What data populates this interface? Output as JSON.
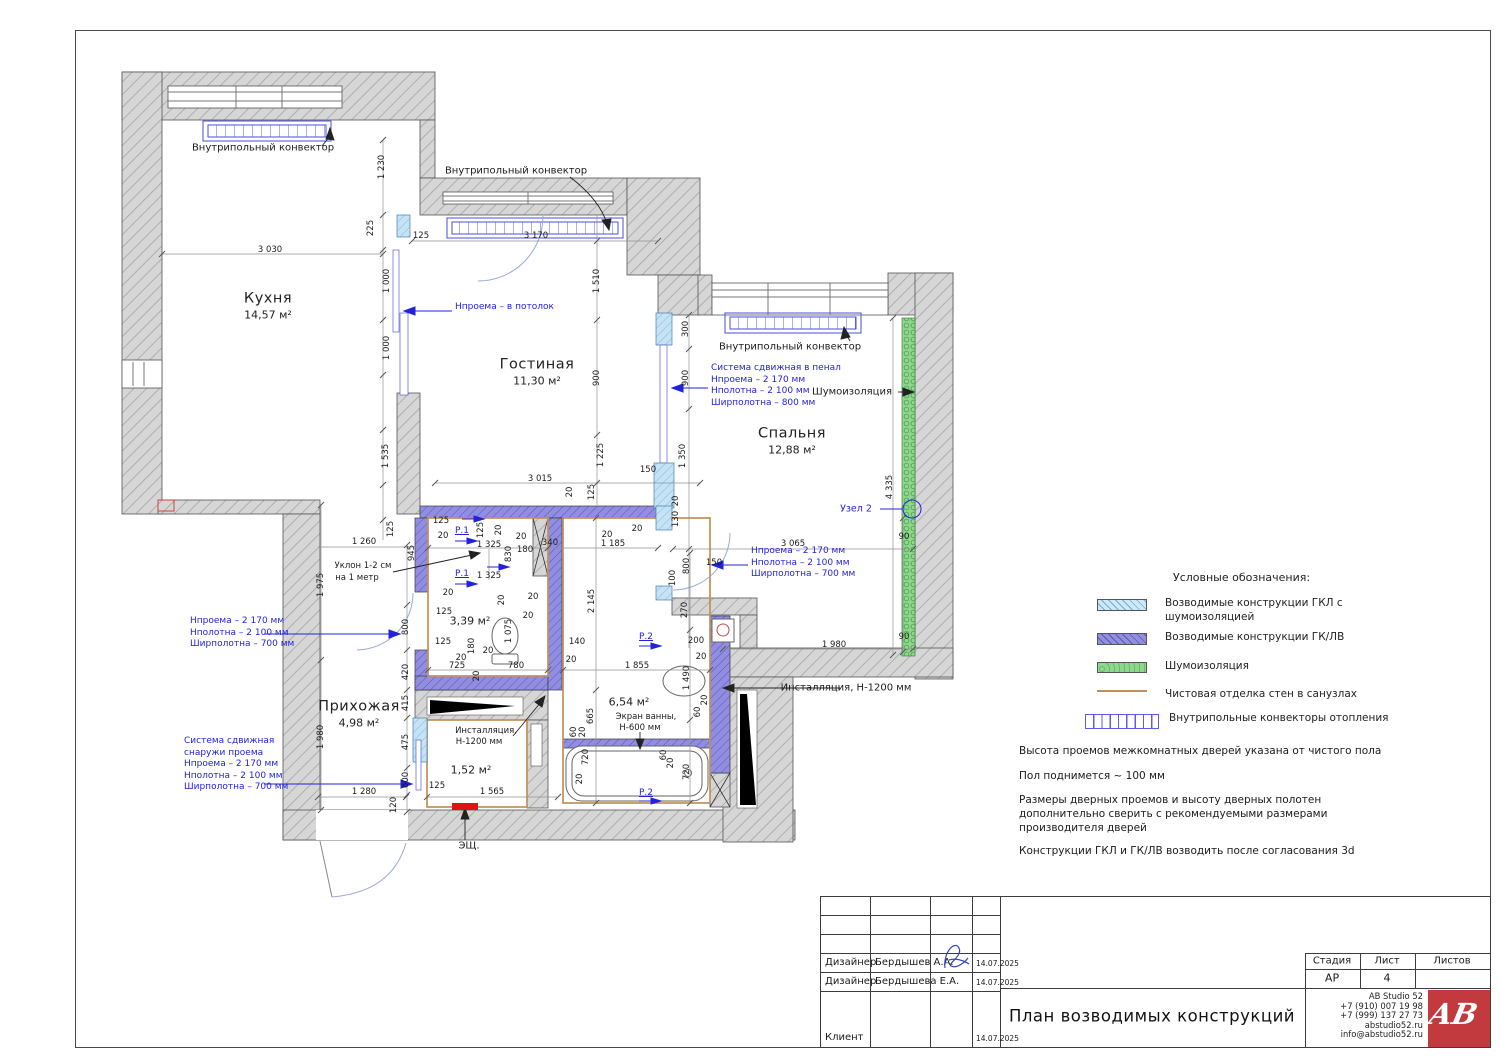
{
  "plan": {
    "rooms": [
      {
        "name": "Кухня",
        "area": "14,57 м²",
        "x": 268,
        "y": 306
      },
      {
        "name": "Гостиная",
        "area": "11,30 м²",
        "x": 537,
        "y": 372
      },
      {
        "name": "Спальня",
        "area": "12,88 м²",
        "x": 792,
        "y": 441
      },
      {
        "name": "Прихожая",
        "area": "4,98 м²",
        "x": 359,
        "y": 714
      },
      {
        "name": "",
        "area": "3,39 м²",
        "x": 470,
        "y": 620
      },
      {
        "name": "",
        "area": "6,54 м²",
        "x": 629,
        "y": 701
      },
      {
        "name": "",
        "area": "1,52 м²",
        "x": 471,
        "y": 769
      }
    ],
    "labels": [
      {
        "t": "Внутрипольный конвектор",
        "x": 263,
        "y": 148,
        "c": "big"
      },
      {
        "t": "Внутрипольный конвектор",
        "x": 516,
        "y": 171,
        "c": "big"
      },
      {
        "t": "Внутрипольный конвектор",
        "x": 790,
        "y": 347,
        "c": "big"
      },
      {
        "t": "Шумоизоляция",
        "x": 852,
        "y": 392,
        "c": "big"
      },
      {
        "t": "Узел 2",
        "x": 856,
        "y": 509,
        "c": "bluep"
      },
      {
        "t": "Уклон 1-2 см",
        "x": 363,
        "y": 566
      },
      {
        "t": "на 1 метр",
        "x": 357,
        "y": 578
      },
      {
        "t": "Инсталляция,",
        "x": 486,
        "y": 731
      },
      {
        "t": "Н-1200 мм",
        "x": 479,
        "y": 742
      },
      {
        "t": "Инсталляция, Н-1200 мм",
        "x": 846,
        "y": 688,
        "c": "big"
      },
      {
        "t": "Экран ванны,",
        "x": 646,
        "y": 717
      },
      {
        "t": "Н-600 мм",
        "x": 640,
        "y": 728
      },
      {
        "t": "ЭЩ.",
        "x": 469,
        "y": 846,
        "c": "big"
      },
      {
        "t": "3 030",
        "x": 270,
        "y": 250
      },
      {
        "t": "1 230",
        "x": 382,
        "y": 167,
        "r": 1
      },
      {
        "t": "225",
        "x": 371,
        "y": 228,
        "r": 1
      },
      {
        "t": "125",
        "x": 421,
        "y": 236
      },
      {
        "t": "3 170",
        "x": 536,
        "y": 236
      },
      {
        "t": "1 510",
        "x": 597,
        "y": 281,
        "r": 1
      },
      {
        "t": "900",
        "x": 597,
        "y": 378,
        "r": 1
      },
      {
        "t": "1 000",
        "x": 387,
        "y": 281,
        "r": 1
      },
      {
        "t": "1 000",
        "x": 387,
        "y": 348,
        "r": 1
      },
      {
        "t": "1 535",
        "x": 386,
        "y": 456,
        "r": 1
      },
      {
        "t": "125",
        "x": 391,
        "y": 529,
        "r": 1
      },
      {
        "t": "300",
        "x": 686,
        "y": 329,
        "r": 1
      },
      {
        "t": "900",
        "x": 686,
        "y": 378,
        "r": 1
      },
      {
        "t": "1 350",
        "x": 683,
        "y": 456,
        "r": 1
      },
      {
        "t": "1 225",
        "x": 601,
        "y": 455,
        "r": 1
      },
      {
        "t": "150",
        "x": 648,
        "y": 470
      },
      {
        "t": "3 015",
        "x": 540,
        "y": 479
      },
      {
        "t": "20",
        "x": 570,
        "y": 492,
        "r": 1
      },
      {
        "t": "125",
        "x": 592,
        "y": 492,
        "r": 1
      },
      {
        "t": "130",
        "x": 676,
        "y": 519,
        "r": 1
      },
      {
        "t": "20",
        "x": 676,
        "y": 501,
        "r": 1
      },
      {
        "t": "150",
        "x": 714,
        "y": 563
      },
      {
        "t": "100",
        "x": 673,
        "y": 578,
        "r": 1
      },
      {
        "t": "800",
        "x": 687,
        "y": 566,
        "r": 1
      },
      {
        "t": "270",
        "x": 685,
        "y": 610,
        "r": 1
      },
      {
        "t": "3 065",
        "x": 793,
        "y": 544
      },
      {
        "t": "90",
        "x": 904,
        "y": 537
      },
      {
        "t": "90",
        "x": 904,
        "y": 637
      },
      {
        "t": "1 980",
        "x": 834,
        "y": 645
      },
      {
        "t": "4 335",
        "x": 890,
        "y": 487,
        "r": 1
      },
      {
        "t": "1 260",
        "x": 364,
        "y": 542
      },
      {
        "t": "945",
        "x": 412,
        "y": 553,
        "r": 1
      },
      {
        "t": "1 975",
        "x": 321,
        "y": 585,
        "r": 1
      },
      {
        "t": "1 980",
        "x": 321,
        "y": 737,
        "r": 1
      },
      {
        "t": "800",
        "x": 406,
        "y": 627,
        "r": 1
      },
      {
        "t": "420",
        "x": 406,
        "y": 672,
        "r": 1
      },
      {
        "t": "415",
        "x": 406,
        "y": 703,
        "r": 1
      },
      {
        "t": "475",
        "x": 406,
        "y": 742,
        "r": 1
      },
      {
        "t": "600",
        "x": 406,
        "y": 780,
        "r": 1
      },
      {
        "t": "120",
        "x": 394,
        "y": 805,
        "r": 1
      },
      {
        "t": "1 280",
        "x": 364,
        "y": 792
      },
      {
        "t": "125",
        "x": 437,
        "y": 786
      },
      {
        "t": "1 565",
        "x": 492,
        "y": 792
      },
      {
        "t": "125",
        "x": 441,
        "y": 521
      },
      {
        "t": "20",
        "x": 443,
        "y": 536
      },
      {
        "t": "Р.1",
        "x": 462,
        "y": 531,
        "c": "blue"
      },
      {
        "t": "125",
        "x": 481,
        "y": 530,
        "r": 1
      },
      {
        "t": "20",
        "x": 499,
        "y": 530,
        "r": 1
      },
      {
        "t": "1 325",
        "x": 489,
        "y": 545
      },
      {
        "t": "20",
        "x": 521,
        "y": 537
      },
      {
        "t": "830",
        "x": 509,
        "y": 554,
        "r": 1
      },
      {
        "t": "180",
        "x": 525,
        "y": 550
      },
      {
        "t": "340",
        "x": 550,
        "y": 543
      },
      {
        "t": "Р.1",
        "x": 462,
        "y": 574,
        "c": "blue"
      },
      {
        "t": "1 325",
        "x": 489,
        "y": 576
      },
      {
        "t": "20",
        "x": 448,
        "y": 593
      },
      {
        "t": "125",
        "x": 444,
        "y": 612
      },
      {
        "t": "20",
        "x": 502,
        "y": 600,
        "r": 1
      },
      {
        "t": "20",
        "x": 533,
        "y": 597
      },
      {
        "t": "1 075",
        "x": 509,
        "y": 631,
        "r": 1
      },
      {
        "t": "20",
        "x": 528,
        "y": 616
      },
      {
        "t": "125",
        "x": 443,
        "y": 642
      },
      {
        "t": "180",
        "x": 472,
        "y": 646,
        "r": 1
      },
      {
        "t": "20",
        "x": 488,
        "y": 651
      },
      {
        "t": "20",
        "x": 461,
        "y": 658
      },
      {
        "t": "725",
        "x": 457,
        "y": 666
      },
      {
        "t": "780",
        "x": 516,
        "y": 666
      },
      {
        "t": "20",
        "x": 477,
        "y": 676,
        "r": 1
      },
      {
        "t": "20",
        "x": 607,
        "y": 535
      },
      {
        "t": "1 185",
        "x": 613,
        "y": 544
      },
      {
        "t": "140",
        "x": 577,
        "y": 642
      },
      {
        "t": "20",
        "x": 571,
        "y": 660
      },
      {
        "t": "1 855",
        "x": 637,
        "y": 666
      },
      {
        "t": "2 145",
        "x": 592,
        "y": 601,
        "r": 1
      },
      {
        "t": "665",
        "x": 591,
        "y": 716,
        "r": 1
      },
      {
        "t": "60",
        "x": 574,
        "y": 732,
        "r": 1
      },
      {
        "t": "20",
        "x": 583,
        "y": 732,
        "r": 1
      },
      {
        "t": "720",
        "x": 586,
        "y": 757,
        "r": 1
      },
      {
        "t": "20",
        "x": 580,
        "y": 779,
        "r": 1
      },
      {
        "t": "Р.2",
        "x": 646,
        "y": 637,
        "c": "blue"
      },
      {
        "t": "Р.2",
        "x": 646,
        "y": 793,
        "c": "blue"
      },
      {
        "t": "200",
        "x": 696,
        "y": 641
      },
      {
        "t": "20",
        "x": 701,
        "y": 657
      },
      {
        "t": "1 490",
        "x": 687,
        "y": 678,
        "r": 1
      },
      {
        "t": "20",
        "x": 705,
        "y": 700,
        "r": 1
      },
      {
        "t": "60",
        "x": 698,
        "y": 712,
        "r": 1
      },
      {
        "t": "720",
        "x": 687,
        "y": 772,
        "r": 1
      },
      {
        "t": "20",
        "x": 671,
        "y": 763,
        "r": 1
      },
      {
        "t": "60",
        "x": 664,
        "y": 755,
        "r": 1
      },
      {
        "t": "20",
        "x": 637,
        "y": 529
      }
    ],
    "annotations": [
      {
        "x": 455,
        "y": 302,
        "lines": [
          "Нпроема – в потолок"
        ]
      },
      {
        "x": 711,
        "y": 363,
        "lines": [
          "Система сдвижная в пенал",
          "Нпроема – 2 170 мм",
          "Нполотна – 2 100 мм",
          "Ширполотна – 800 мм"
        ]
      },
      {
        "x": 751,
        "y": 546,
        "lines": [
          "Нпроема – 2 170 мм",
          "Нполотна – 2 100 мм",
          "Ширполотна – 700 мм"
        ]
      },
      {
        "x": 190,
        "y": 616,
        "lines": [
          "Нпроема – 2 170 мм",
          "Нполотна – 2 100 мм",
          "Ширполотна – 700 мм"
        ]
      },
      {
        "x": 184,
        "y": 736,
        "lines": [
          "Система сдвижная",
          "снаружи проема",
          "Нпроема – 2 170 мм",
          "Нполотна – 2 100 мм",
          "Ширполотна – 700 мм"
        ]
      }
    ]
  },
  "legend": {
    "title": "Условные обозначения:",
    "items": [
      {
        "type": "gkl",
        "lines": [
          "Возводимые конструкции ГКЛ с",
          "шумоизоляцией"
        ]
      },
      {
        "type": "gklv",
        "lines": [
          "Возводимые конструкции ГК/ЛВ"
        ]
      },
      {
        "type": "snd",
        "lines": [
          "Шумоизоляция"
        ]
      },
      {
        "type": "fin",
        "lines": [
          "Чистовая отделка стен в санузлах"
        ]
      },
      {
        "type": "conv",
        "lines": [
          "Внутрипольные конвекторы отопления"
        ]
      }
    ]
  },
  "notes": [
    [
      "Высота проемов межкомнатных дверей указана от чистого пола"
    ],
    [
      "Пол поднимется ~ 100 мм"
    ],
    [
      "Размеры дверных проемов и высоту дверных полотен",
      "дополнительно сверить с рекомендуемыми размерами",
      "производителя дверей"
    ],
    [
      "Конструкции ГКЛ и ГК/ЛВ возводить после согласования 3d"
    ]
  ],
  "titleblock": {
    "rows": [
      {
        "role": "Дизайнер",
        "name": "Бердышев А.А.",
        "date": "14.07.2025"
      },
      {
        "role": "Дизайнер",
        "name": "Бердышева Е.А.",
        "date": "14.07.2025"
      },
      {
        "role": "Клиент",
        "name": "",
        "date": "14.07.2025"
      }
    ],
    "stage_headers": [
      "Стадия",
      "Лист",
      "Листов"
    ],
    "stage_values": [
      "АР",
      "4",
      ""
    ],
    "title": "План возводимых конструкций",
    "company": [
      "AB Studio 52",
      "+7 (910) 007 19 98",
      "+7 (999) 137 27 73",
      "abstudio52.ru",
      "info@abstudio52.ru"
    ],
    "logo_text": "AB"
  },
  "colors": {
    "wall_gray": "#d6d6d6",
    "gklv_purple": "#918de0",
    "gkl_blue": "#c6e3f5",
    "sound_green": "#8fd78f",
    "finish_tan": "#c09058",
    "annotation_blue": "#2222dd",
    "red": "#dd1512",
    "logo_red": "#c23a3e"
  }
}
